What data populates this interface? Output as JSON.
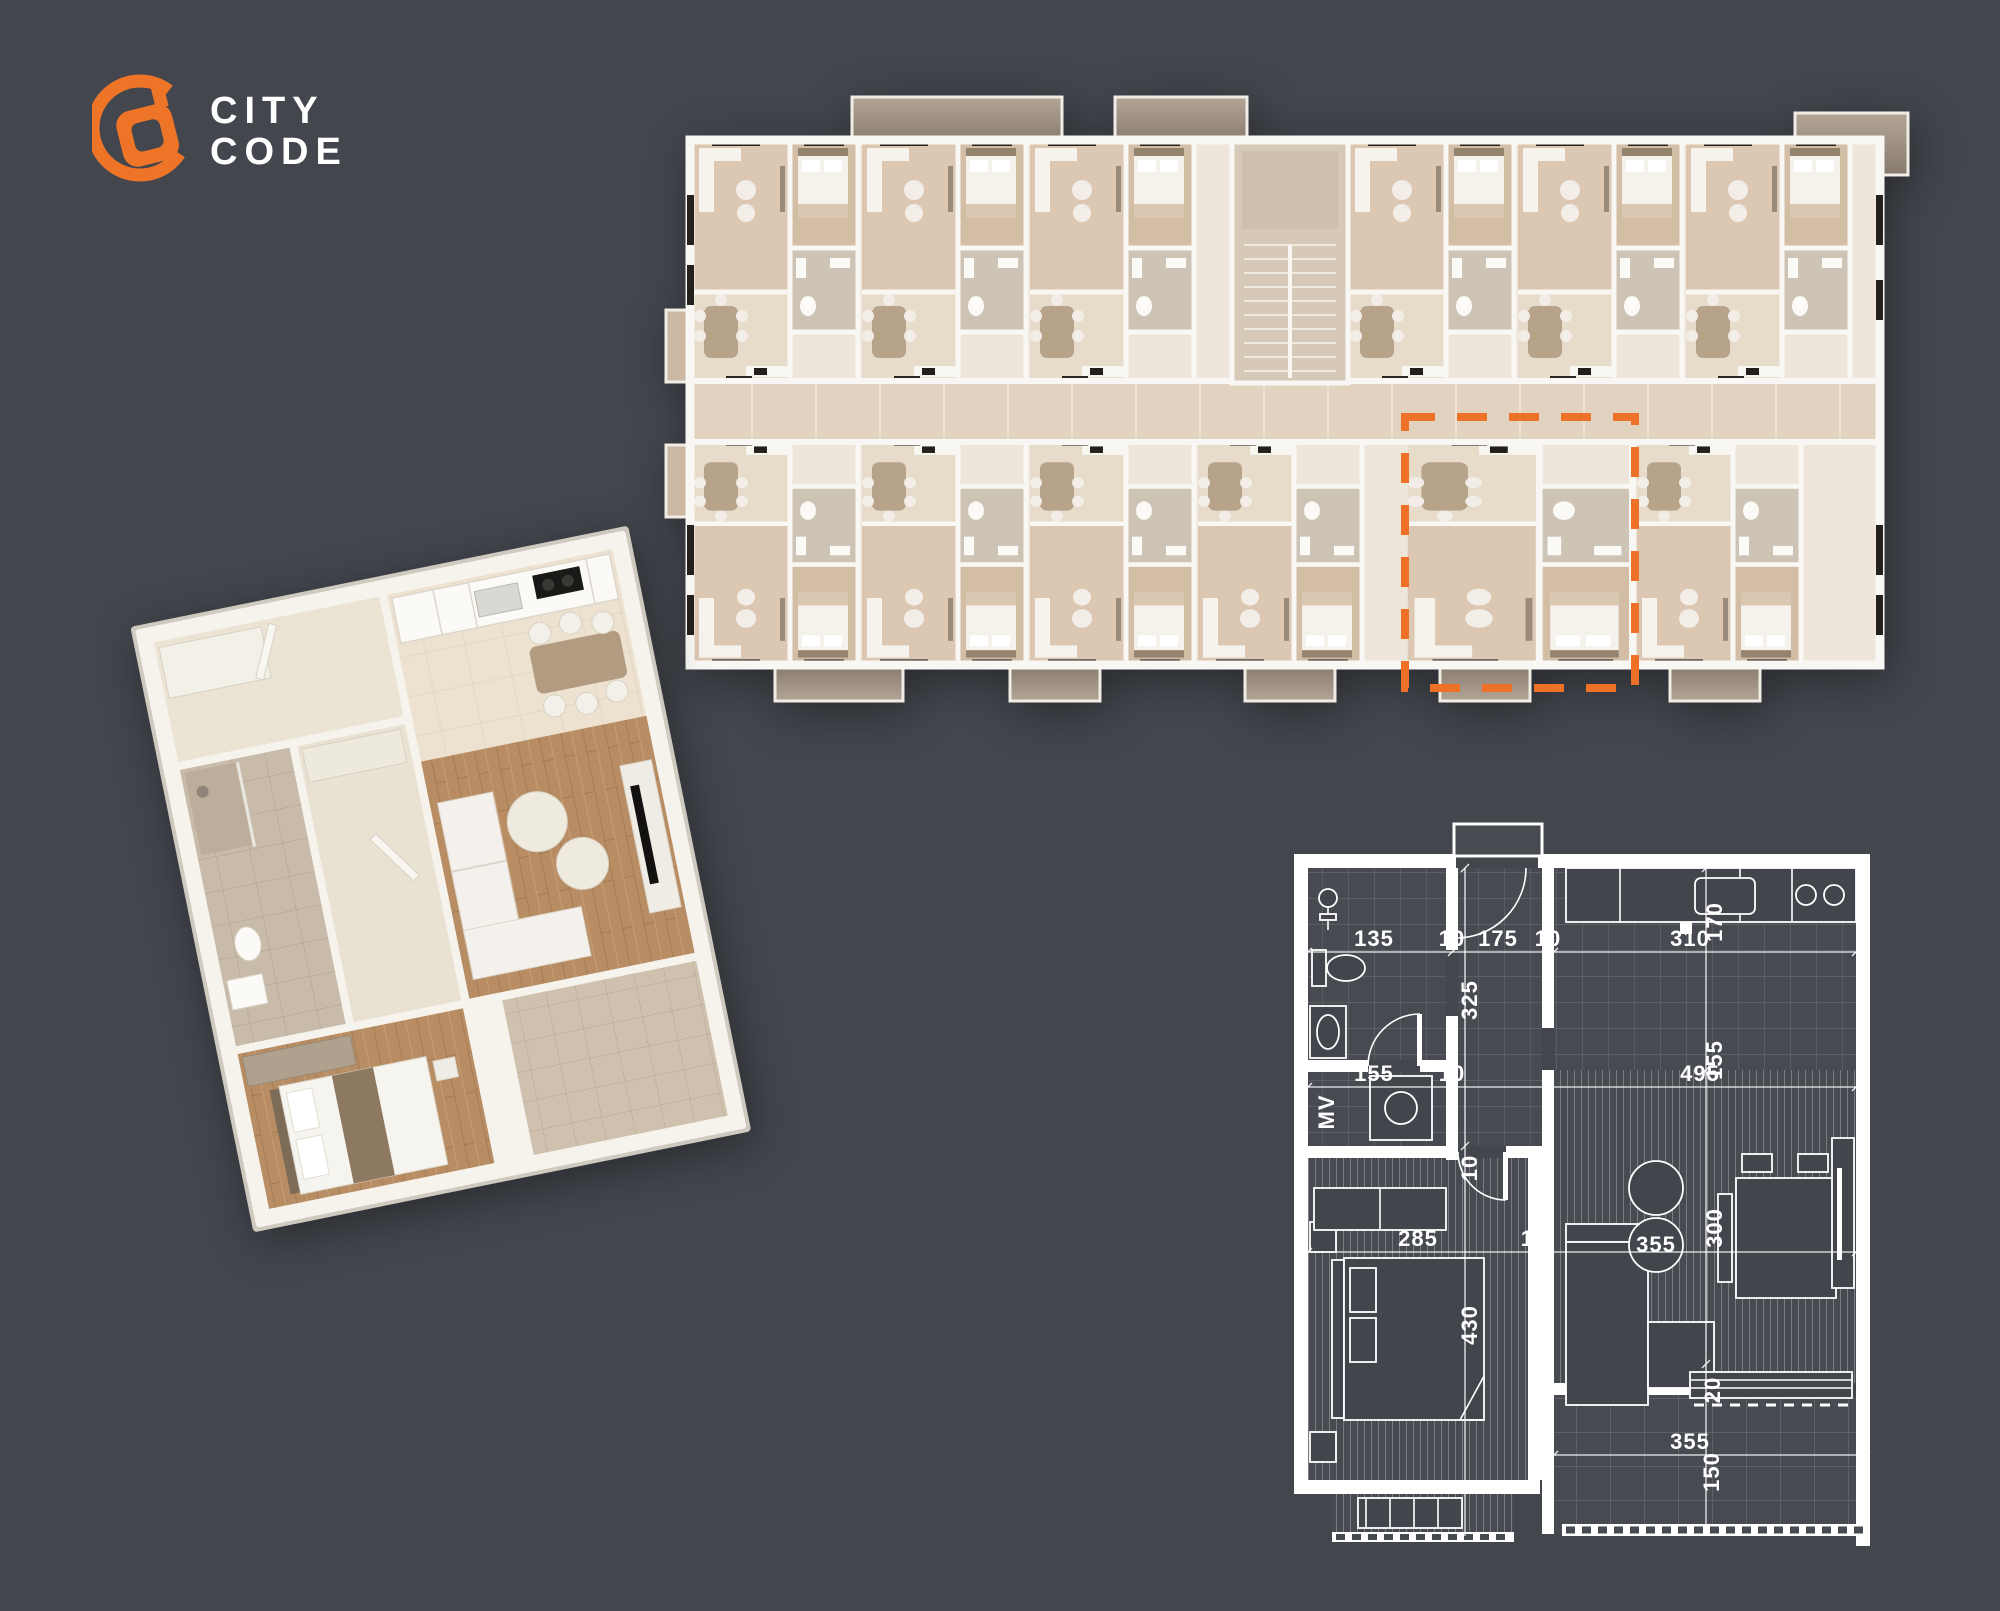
{
  "canvas": {
    "width": 2000,
    "height": 1611,
    "background_color": "#43464d"
  },
  "logo": {
    "line1": "CITY",
    "line2": "CODE",
    "ring_color": "#EE7428",
    "text_color": "#ffffff"
  },
  "building_plan": {
    "highlight_color": "#ED7228",
    "wall_color": "#f9f7f3",
    "floor_color": "#ece4d8",
    "corridor_color": "#e2d2c0",
    "balcony_stone_color": "#a89a8b"
  },
  "unit_3d": {
    "wall_color": "#f6f3ed",
    "wood_floor_color": "#b88d63",
    "bath_tile_color": "#c8bba9",
    "balcony_tile_color": "#cfc1ad"
  },
  "technical_plan": {
    "line_color": "#ffffff",
    "room_fill": "#474a51",
    "dims": {
      "bath_w": "135",
      "wall_a": "10",
      "hall_w": "175",
      "wall_b": "10",
      "kitchen_w": "310",
      "kitchen_d": "170",
      "hall_d": "325",
      "bath2_w": "155",
      "wall_c": "10",
      "living_w": "495",
      "dining_d": "155",
      "mv": "MV",
      "hall_door": "10",
      "bed_w": "285",
      "wall_d": "10",
      "bed_d": "430",
      "coffee_w": "355",
      "living_d": "300",
      "sideboard_d": "20",
      "terrace_w": "355",
      "terrace_d": "150"
    }
  }
}
